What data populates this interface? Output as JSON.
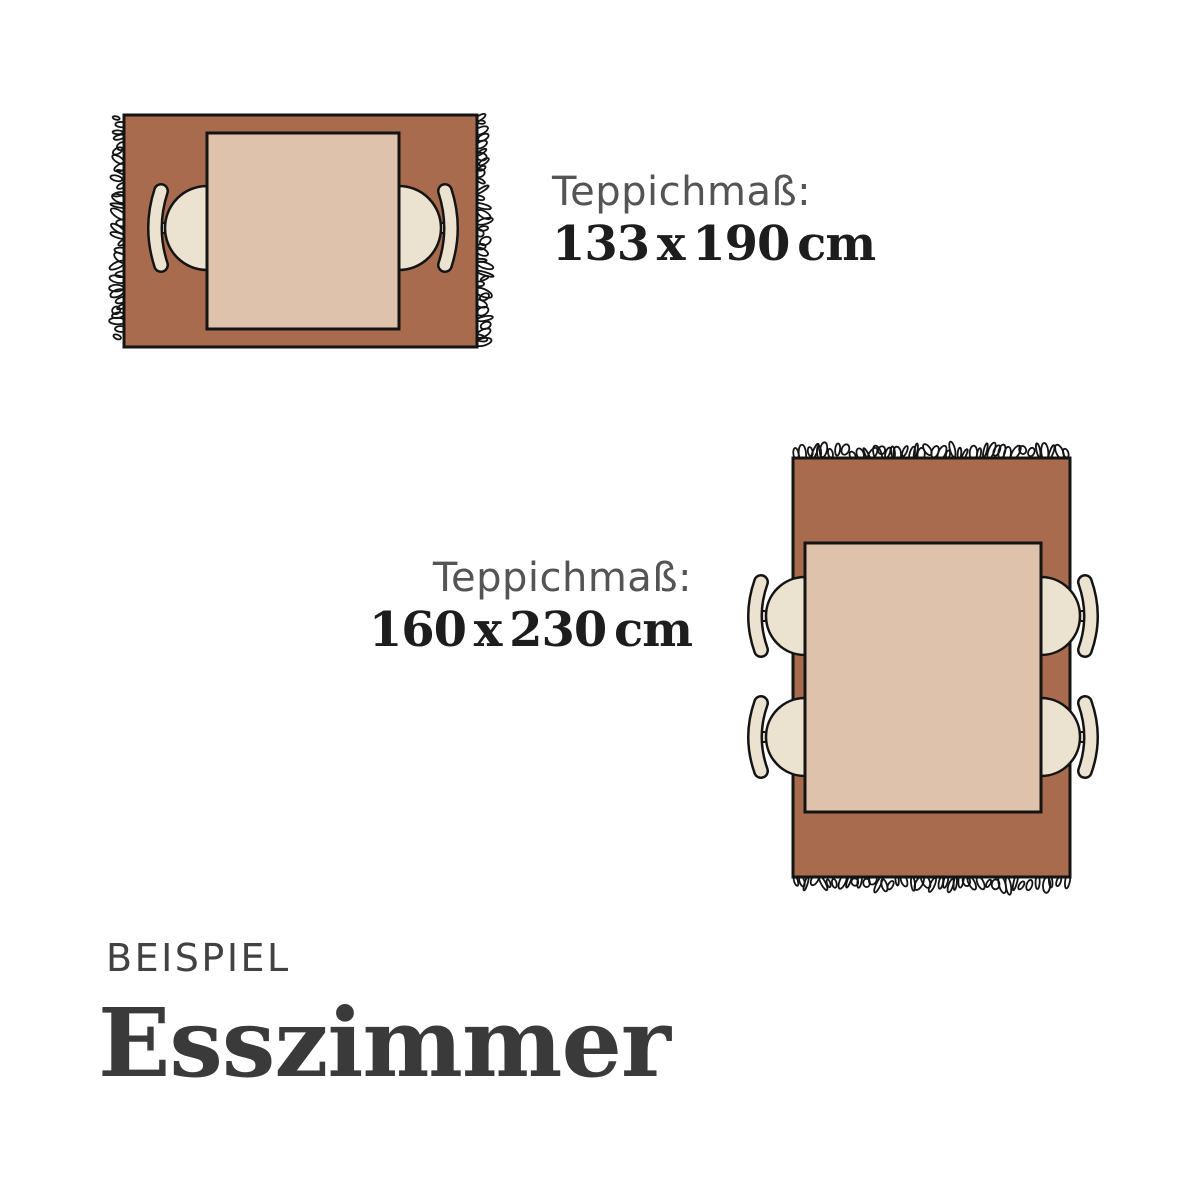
{
  "colors": {
    "rug": "#a96b4d",
    "table": "#dfc2ab",
    "chair": "#ece2d0",
    "outline": "#141414",
    "label_gray": "#545454",
    "dim_dark": "#1d1d1d",
    "title_gray": "#424242",
    "heading_dark": "#3a3a3a"
  },
  "diagrams": [
    {
      "id": "rug-133x190",
      "label": "Teppichmaß:",
      "dimensions": "133 x 190 cm",
      "orientation": "landscape",
      "chairs": 2,
      "fringe_edges": "left-right"
    },
    {
      "id": "rug-160x230",
      "label": "Teppichmaß:",
      "dimensions": "160 x 230 cm",
      "orientation": "portrait",
      "chairs": 4,
      "fringe_edges": "top-bottom"
    }
  ],
  "footer": {
    "eyebrow": "BEISPIEL",
    "heading": "Esszimmer"
  }
}
